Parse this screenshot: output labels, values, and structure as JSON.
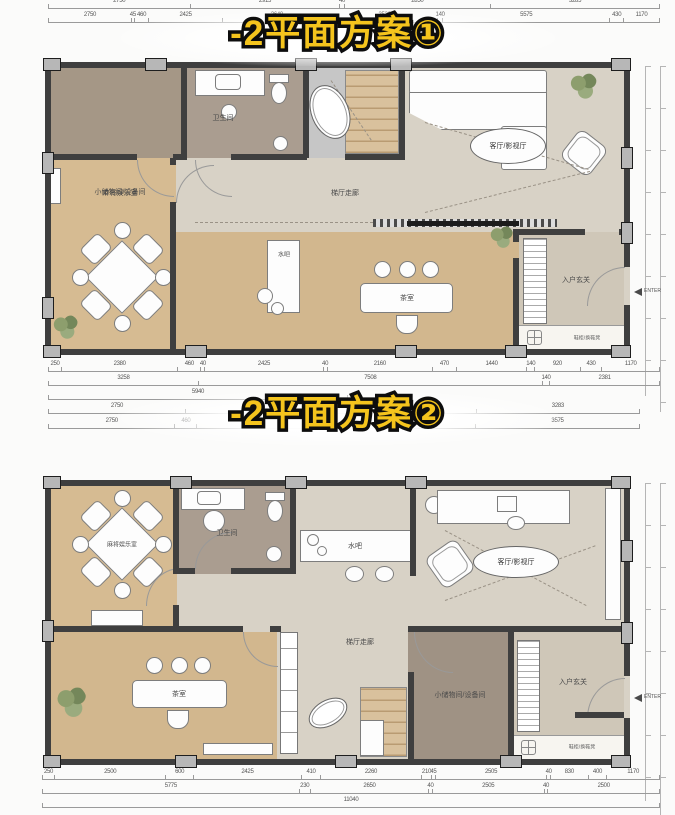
{
  "titles": {
    "plan1": "-2平面方案①",
    "plan2": "-2平面方案②"
  },
  "labels1": {
    "storage": "小储物间/设备间",
    "bath": "卫生间",
    "mahjong": "麻将娱乐室",
    "corridor": "梯厅走廊",
    "living": "客厅/影视厅",
    "bar": "水吧",
    "tea": "茶室",
    "foyer": "入户玄关",
    "shoe": "鞋柜/换鞋凳"
  },
  "labels2": {
    "storage": "小储物间/设备间",
    "bath": "卫生间",
    "mahjong": "麻将娱乐室",
    "corridor": "梯厅走廊",
    "living": "客厅/影视厅",
    "bar": "水吧",
    "tea": "茶室",
    "foyer": "入户玄关",
    "shoe": "鞋柜/换鞋凳"
  },
  "enter_label": "ENTER",
  "dims": {
    "top1": [
      "2750",
      "2915",
      "40",
      "2850",
      "3285"
    ],
    "top2": [
      "2750",
      "45",
      "460",
      "2425",
      "3640",
      "3520",
      "140",
      "5575",
      "430",
      "1170"
    ],
    "p1b1": [
      "250",
      "2380",
      "460",
      "40",
      "2425",
      "40",
      "2160",
      "470",
      "1440",
      "140",
      "920",
      "430",
      "1170"
    ],
    "p1b2": [
      "3258",
      "7508",
      "140",
      "2381"
    ],
    "p1b3": [
      "5940"
    ],
    "mid1": [
      "2750",
      "2915",
      "40",
      "2850",
      "3283"
    ],
    "mid2": [
      "2750",
      "460",
      "2425",
      "3640",
      "3575"
    ],
    "p2b1": [
      "250",
      "2500",
      "600",
      "2425",
      "410",
      "2260",
      "210",
      "45",
      "2505",
      "40",
      "830",
      "400",
      "1170"
    ],
    "p2b2": [
      "5775",
      "230",
      "2650",
      "40",
      "2505",
      "40",
      "2500"
    ],
    "p2b3": [
      "11040"
    ]
  },
  "colors": {
    "title_yellow": "#f4c41d",
    "wall": "#3f3f3f",
    "wood_floor": "#d6bb92",
    "taupe_floor": "#a59786",
    "cream_floor": "#d8d2c6"
  }
}
